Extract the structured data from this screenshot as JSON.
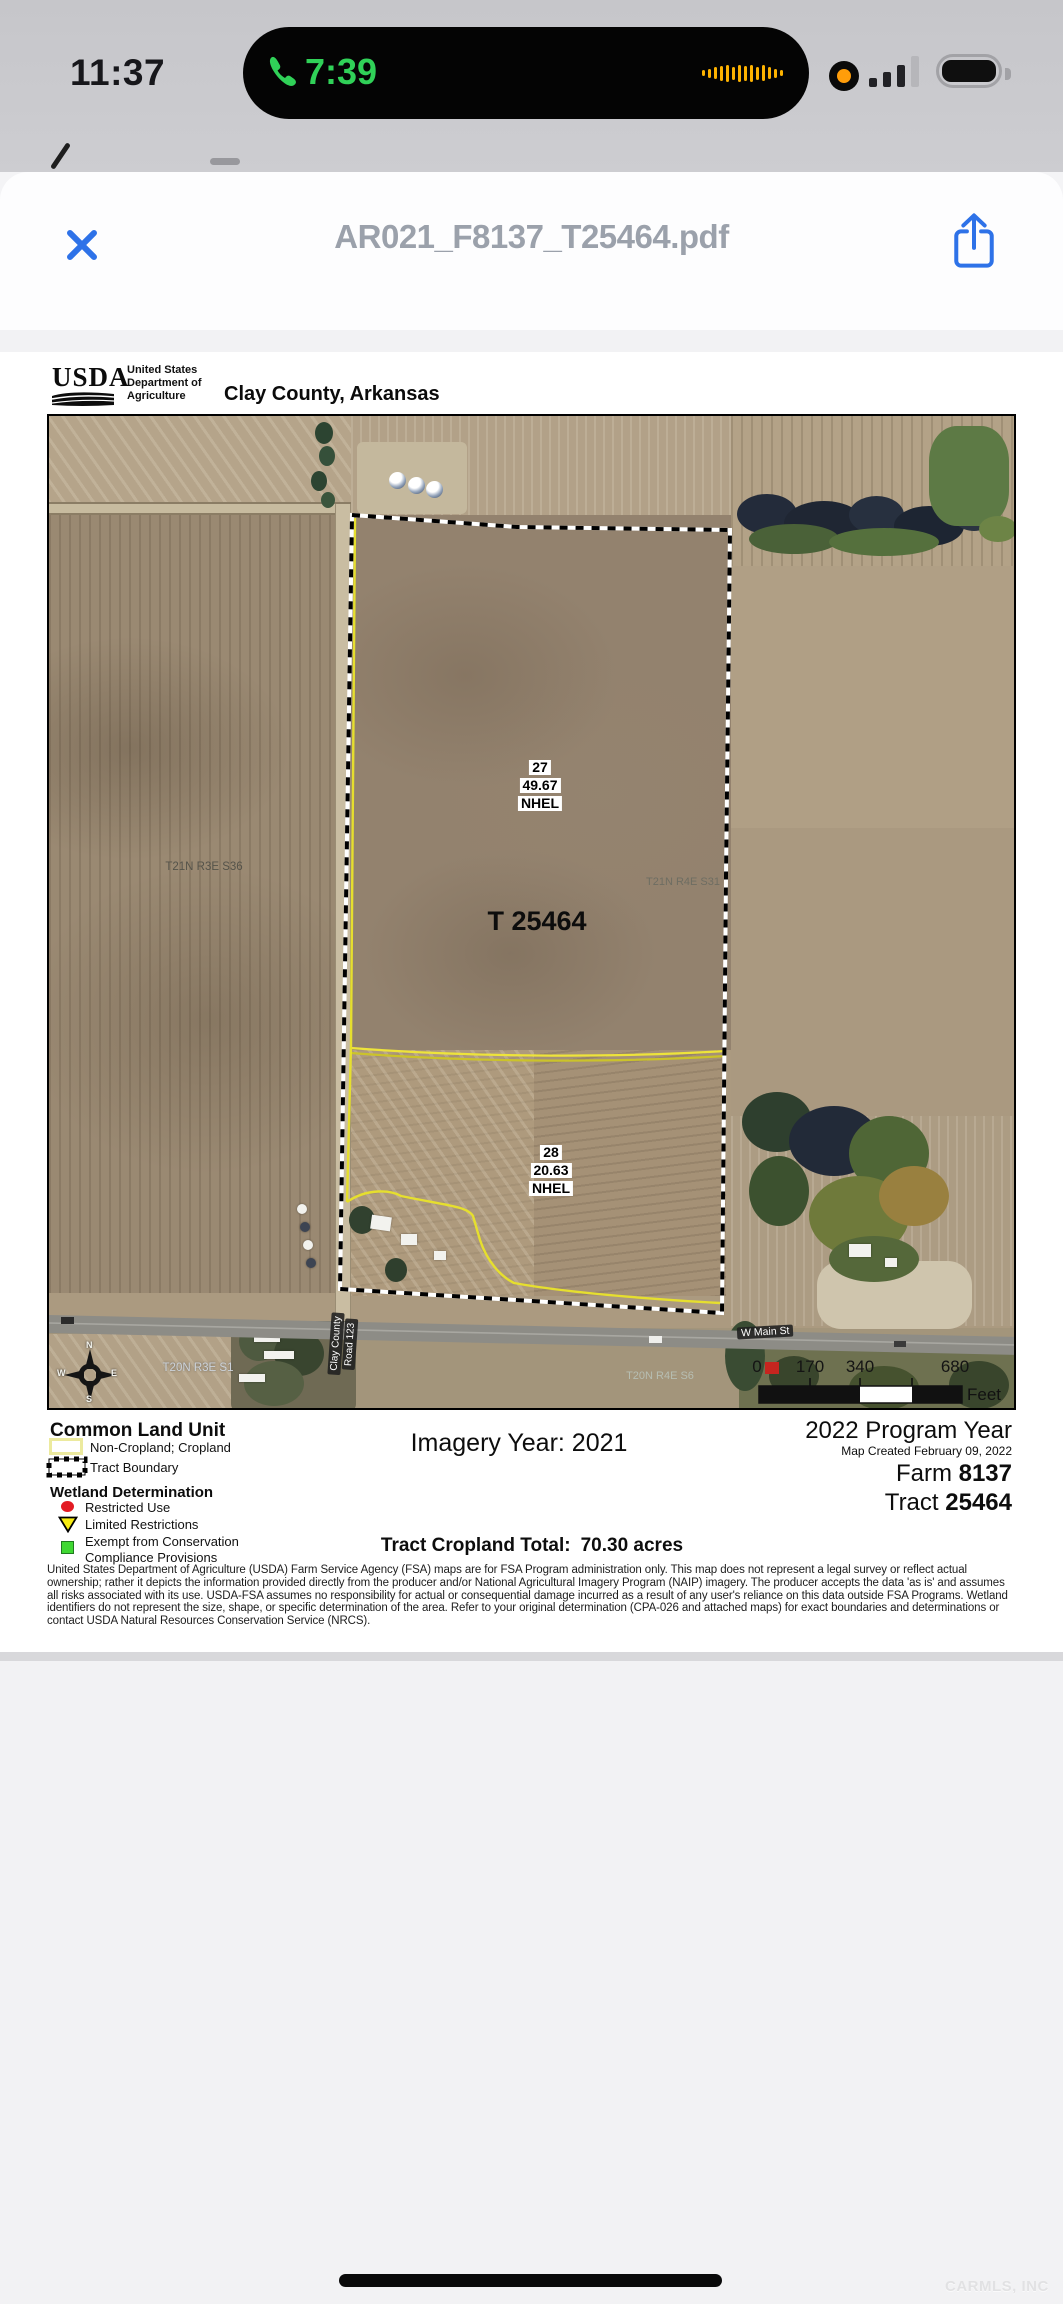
{
  "status_bar": {
    "time": "11:37",
    "call_time": "7:39"
  },
  "viewer": {
    "title": "AR021_F8137_T25464.pdf"
  },
  "document": {
    "agency_logo_text": "USDA",
    "agency_name_lines": [
      "United States",
      "Department of",
      "Agriculture"
    ],
    "doc_title": "Clay County, Arkansas",
    "map": {
      "tract_label": "T 25464",
      "field_labels": [
        {
          "clu": "27",
          "acres": "49.67",
          "hel": "NHEL"
        },
        {
          "clu": "28",
          "acres": "20.63",
          "hel": "NHEL"
        }
      ],
      "plss_labels": {
        "nw": "T21N R3E S36",
        "ne": "T21N R4E S31",
        "sw": "T20N R3E S1",
        "se": "T20N R4E S6"
      },
      "road_labels": {
        "main_street": "W Main St",
        "county_road_line1": "Clay County",
        "county_road_line2": "Road 123"
      },
      "compass": {
        "n": "N",
        "e": "E",
        "s": "S",
        "w": "W"
      },
      "scale_bar": {
        "ticks": [
          "0",
          "170",
          "340",
          "680"
        ],
        "unit": "Feet"
      }
    },
    "legend": {
      "clu_heading": "Common Land Unit",
      "noncropland_label": "Non-Cropland; Cropland",
      "tract_boundary_label": "Tract Boundary",
      "wetland_heading": "Wetland Determination",
      "restricted_label": "Restricted Use",
      "limited_label": "Limited Restrictions",
      "exempt_label_line1": "Exempt from Conservation",
      "exempt_label_line2": "Compliance Provisions"
    },
    "info": {
      "imagery_year": "Imagery Year: 2021",
      "program_year": "2022 Program Year",
      "map_created": "Map Created February 09, 2022",
      "farm_label": "Farm",
      "farm_number": "8137",
      "tract_label": "Tract",
      "tract_number": "25464",
      "cropland_total_label": "Tract Cropland Total:",
      "cropland_total_value": "70.30 acres"
    },
    "disclaimer": "United States Department of Agriculture (USDA) Farm Service Agency (FSA) maps are for FSA Program administration only.  This map does not represent a legal survey or reflect actual ownership; rather it depicts the information provided directly from the producer and/or National Agricultural Imagery Program (NAIP) imagery.  The producer accepts the data 'as is' and assumes all risks associated with its use.  USDA-FSA assumes no responsibility for actual or consequential damage incurred as a result of any user's reliance on this data outside FSA Programs.  Wetland identifiers do not represent the size, shape, or specific determination of the area.  Refer to your original determination (CPA-026 and attached maps) for exact boundaries and determinations or contact USDA Natural Resources Conservation Service (NRCS)."
  },
  "watermark": "CARMLS, INC",
  "colors": {
    "accent_blue": "#2e72e8",
    "call_green": "#30d158",
    "waveform_orange": "#fdb200",
    "record_orange": "#ff9d0a",
    "restricted_red": "#e31b23",
    "limited_yellow": "#f7ec13",
    "exempt_green": "#3fd832",
    "boundary_yellow": "#e8e232",
    "title_gray": "#9ba1ab"
  }
}
